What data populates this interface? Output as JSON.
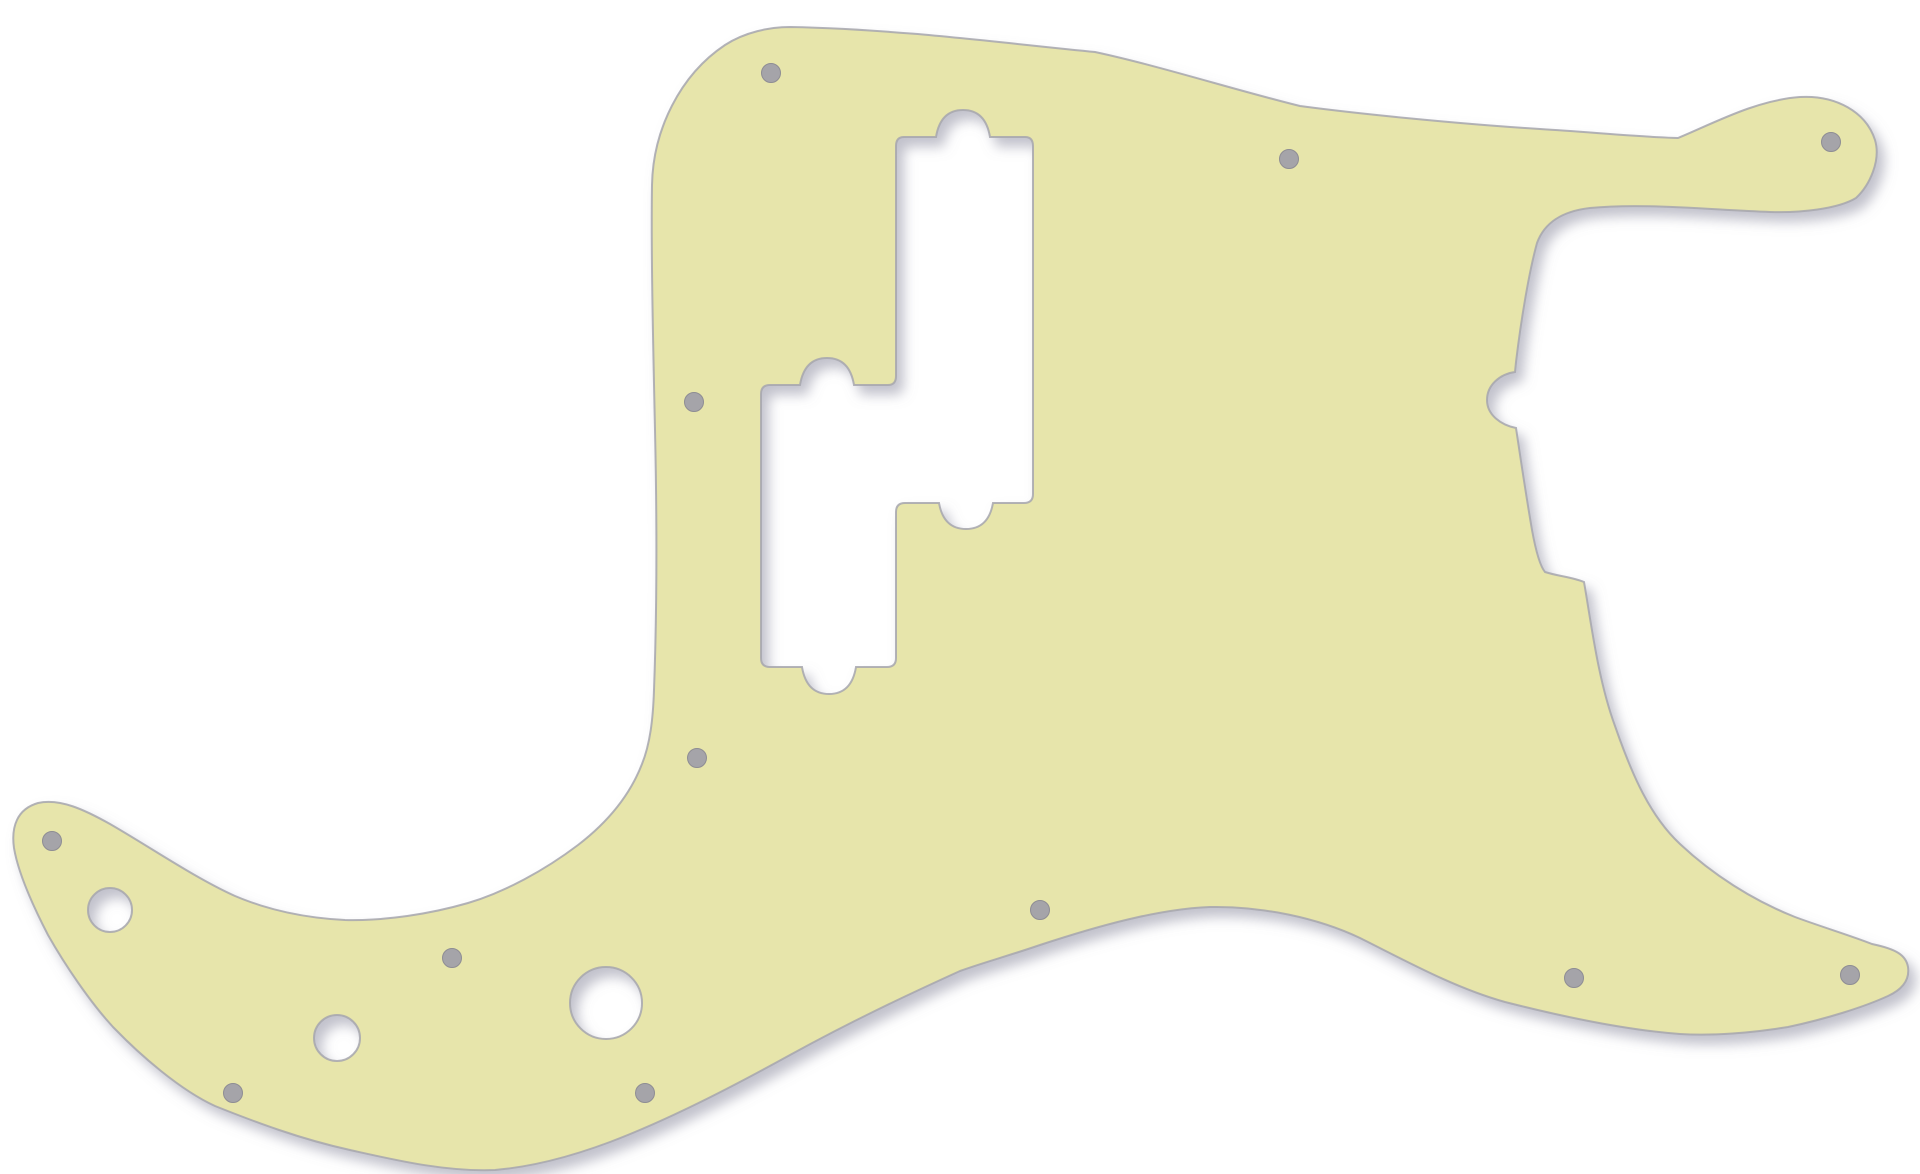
{
  "image": {
    "width": 1920,
    "height": 1174
  },
  "colors": {
    "background": "#ffffff",
    "pickguard_fill": "#e7e5ab",
    "edge_stroke": "#a6a6ae",
    "screw_hole_fill": "#a5a4a9",
    "screw_hole_rim": "#8e8d94",
    "shadow_color": "#85859a"
  },
  "pickguard": {
    "outline_path": "M 790 27 C 900 29 1010 44 1095 52 C 1160 66 1235 90 1300 106 C 1360 114 1460 124 1540 129 C 1590 132 1640 137 1678 138 C 1712 124 1756 100 1800 97 C 1836 95 1866 112 1875 140 C 1881 160 1870 185 1856 198 C 1838 209 1800 213 1770 212 C 1700 209 1640 203 1590 208 C 1564 211 1545 221 1537 243 C 1529 272 1521 320 1516 362 L 1515 372 C 1500 374 1487 385 1487 400 C 1487 415 1501 425 1516 428 C 1520 455 1526 495 1532 530 C 1536 552 1540 566 1545 572 C 1557 576 1572 577 1584 582 C 1591 622 1598 680 1615 726 C 1632 775 1650 816 1680 844 C 1712 874 1752 900 1795 917 C 1822 927 1852 936 1872 944 C 1896 949 1906 955 1908 967 C 1910 981 1901 990 1888 996 C 1864 1007 1826 1019 1788 1027 C 1752 1033 1712 1036 1680 1034 C 1625 1030 1560 1016 1505 1002 C 1455 988 1408 962 1360 938 C 1318 918 1262 906 1210 907 C 1158 909 1098 926 1040 945 C 1008 956 985 962 960 971 C 905 996 850 1022 790 1055 C 730 1088 668 1120 610 1142 C 570 1157 530 1167 495 1170 C 445 1172 395 1160 350 1150 C 300 1139 255 1122 215 1106 C 180 1090 140 1055 113 1027 C 90 1002 65 965 48 935 C 33 906 18 872 14 848 C 11 827 17 809 38 803 C 60 798 85 810 110 824 C 150 847 195 878 235 896 C 268 910 305 918 345 920 C 385 921 430 914 468 903 C 505 892 545 870 578 845 C 608 822 630 795 642 764 C 650 744 653 720 654 690 C 657 610 657 520 655 430 C 653 340 651 250 652 185 C 653 130 680 75 725 45 C 745 32 770 27 790 27 Z",
    "pickup_cutout_path": "M 904 137 L 936 137 C 939 119 948 110 963 110 C 978 110 987 119 990 137 L 1025 137 Q 1033 137 1033 146 L 1033 494 Q 1033 503 1024 503 L 993 503 C 990 520 981 529 966 529 C 951 529 942 520 939 503 L 905 503 Q 896 503 896 512 L 896 658 Q 896 667 887 667 L 856 667 C 853 685 844 694 829 694 C 814 694 805 685 802 667 L 770 667 Q 761 667 761 658 L 761 394 Q 761 385 770 385 L 800 385 C 803 367 812 358 827 358 C 842 358 851 367 854 385 L 888 385 Q 896 385 896 376 L 896 146 Q 896 137 904 137 Z",
    "large_holes": [
      {
        "cx": 110,
        "cy": 910,
        "r": 22
      },
      {
        "cx": 337,
        "cy": 1038,
        "r": 23
      },
      {
        "cx": 606,
        "cy": 1003,
        "r": 36
      }
    ],
    "screw_hole_radius": 9.5,
    "screw_holes": [
      {
        "cx": 771,
        "cy": 73
      },
      {
        "cx": 1289,
        "cy": 159
      },
      {
        "cx": 1831,
        "cy": 142
      },
      {
        "cx": 694,
        "cy": 402
      },
      {
        "cx": 697,
        "cy": 758
      },
      {
        "cx": 52,
        "cy": 841
      },
      {
        "cx": 233,
        "cy": 1093
      },
      {
        "cx": 452,
        "cy": 958
      },
      {
        "cx": 645,
        "cy": 1093
      },
      {
        "cx": 1040,
        "cy": 910
      },
      {
        "cx": 1574,
        "cy": 978
      },
      {
        "cx": 1850,
        "cy": 975
      }
    ]
  }
}
